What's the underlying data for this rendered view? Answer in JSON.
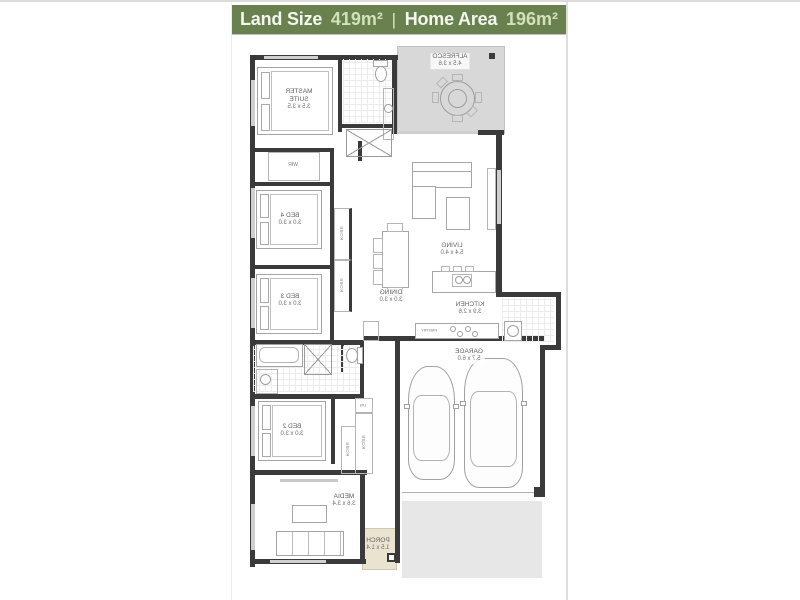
{
  "header": {
    "land_size_label": "Land Size",
    "land_size_value": "419m²",
    "divider": "|",
    "home_area_label": "Home Area",
    "home_area_value": "196m²"
  },
  "floorplan": {
    "rooms": [
      {
        "name": "ALFRESCO",
        "dims": "4.5 x 3.6"
      },
      {
        "name": "MASTER SUITE",
        "dims": "3.5 x 3.5"
      },
      {
        "name": "BED 4",
        "dims": "3.0 x 3.0"
      },
      {
        "name": "BED 3",
        "dims": "3.0 x 3.0"
      },
      {
        "name": "BED 2",
        "dims": "3.0 x 3.0"
      },
      {
        "name": "LIVING",
        "dims": "5.4 x 4.0"
      },
      {
        "name": "DINING",
        "dims": "3.0 x 3.0"
      },
      {
        "name": "KITCHEN",
        "dims": "3.9 x 2.6"
      },
      {
        "name": "GARAGE",
        "dims": "5.7 x 6.0"
      },
      {
        "name": "MEDIA",
        "dims": "3.6 x 3.4"
      },
      {
        "name": "PORCH",
        "dims": "1.5 x 1.4"
      }
    ],
    "labels": {
      "wir": "WIR",
      "robe": "ROBE",
      "linen": "LIN",
      "pantry": "PANTRY"
    }
  },
  "colors": {
    "header_bg": "#69814f",
    "header_value": "#d3e0b8",
    "wall": "#3a3a3a",
    "alfresco_fill": "#d8d8d8",
    "driveway_fill": "#e7e7e7",
    "porch_fill": "#e9e3d0"
  }
}
